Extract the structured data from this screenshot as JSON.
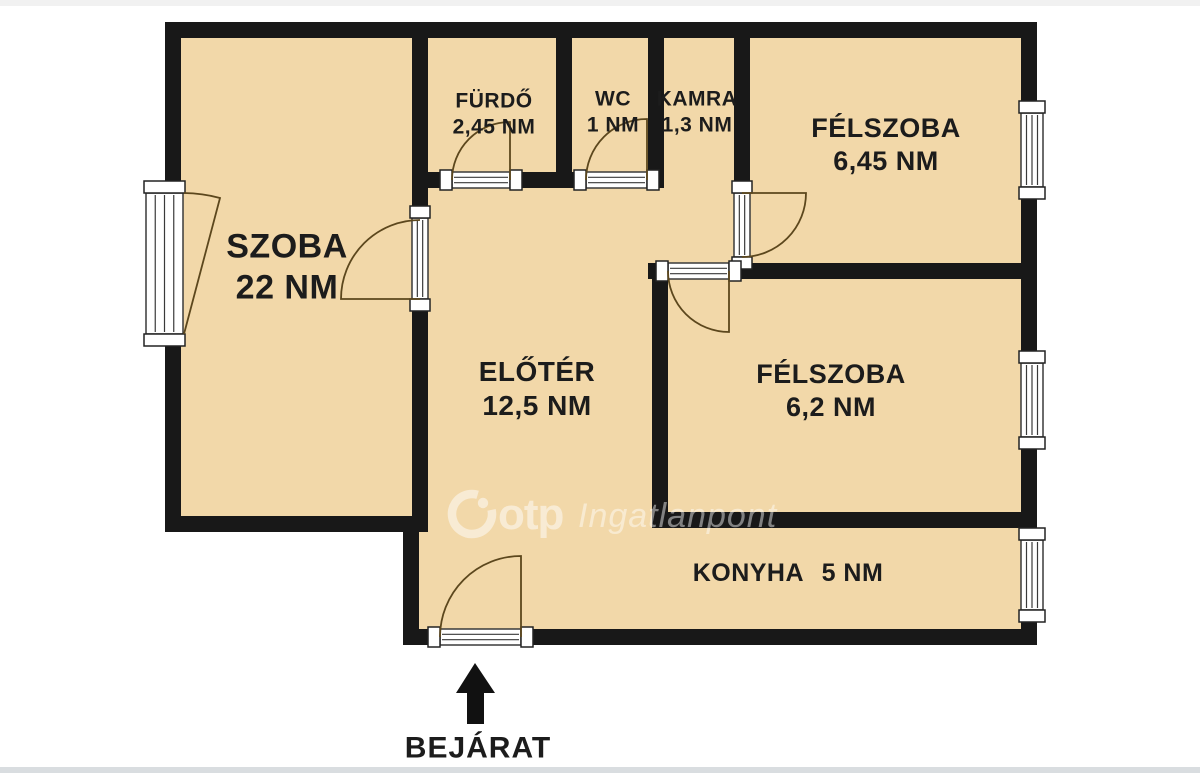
{
  "plan": {
    "rooms": [
      {
        "name": "SZOBA",
        "area": "22 NM"
      },
      {
        "name": "FÜRDŐ",
        "area": "2,45 NM"
      },
      {
        "name": "WC",
        "area": "1 NM"
      },
      {
        "name": "KAMRA",
        "area": "1,3 NM"
      },
      {
        "name": "FÉLSZOBA",
        "area": "6,45 NM"
      },
      {
        "name": "FÉLSZOBA",
        "area": "6,2 NM"
      },
      {
        "name": "ELŐTÉR",
        "area": "12,5 NM"
      },
      {
        "name": "KONYHA",
        "area": "5 NM"
      }
    ],
    "entrance": {
      "label": "BEJÁRAT"
    },
    "watermark": {
      "brand": "otp",
      "suffix": "Ingatlanpont"
    },
    "colors": {
      "floor": "#f2d8a9",
      "wall": "#181818",
      "door": "#5c471d",
      "text": "#1c1c1c",
      "frame_stroke": "#3a3a3a",
      "watermark": "#ffffff"
    }
  }
}
